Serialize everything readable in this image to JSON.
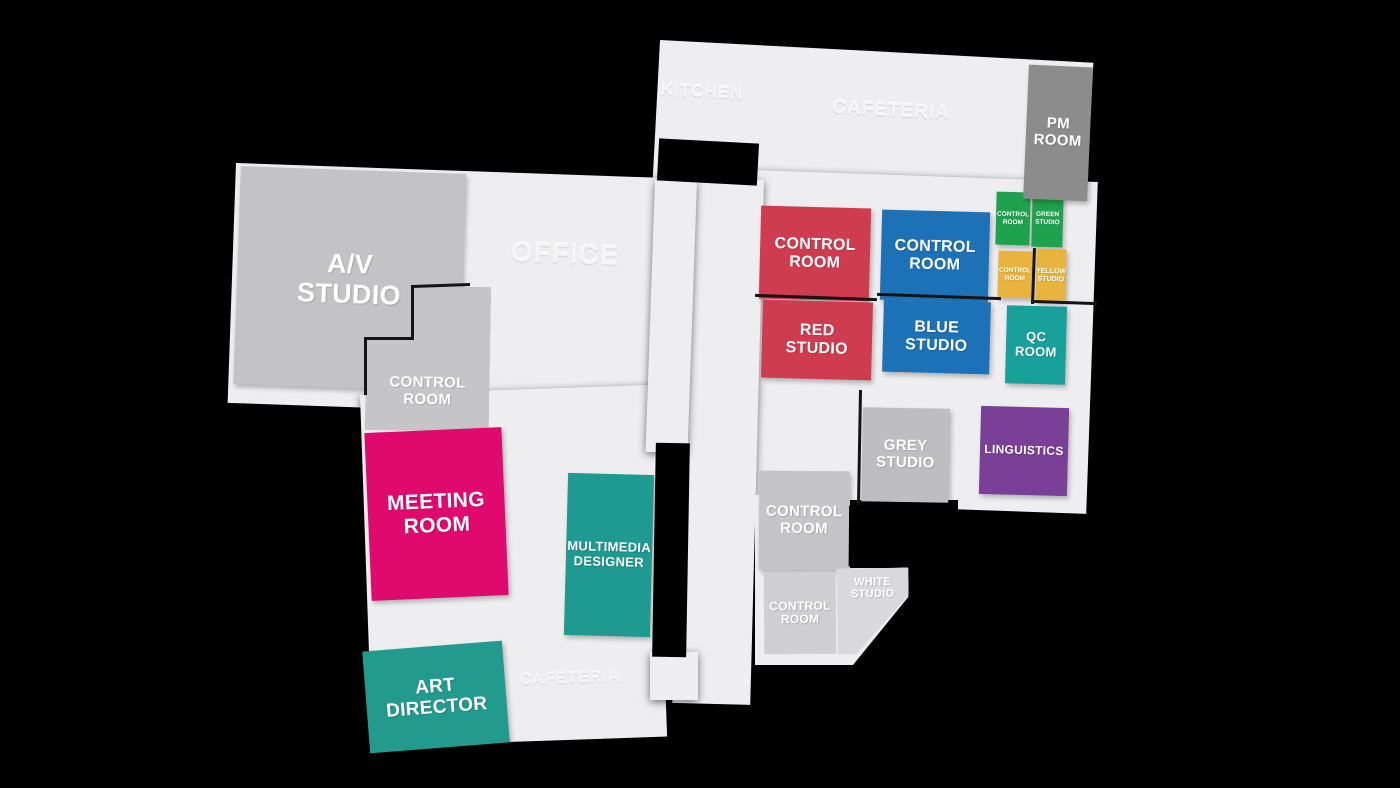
{
  "background": "#000000",
  "floor": {
    "color": "#eeeef0"
  },
  "areas": {
    "kitchen": {
      "label": "KITCHEN"
    },
    "cafeteria": {
      "label": "CAFETERIA"
    },
    "office": {
      "label": "OFFICE"
    },
    "cafeteria_south": {
      "label": "CAFETERIA"
    }
  },
  "rooms": {
    "av_studio": {
      "label": "A/V\nSTUDIO",
      "color": "#c3c3c5"
    },
    "control_room_west": {
      "label": "CONTROL\nROOM",
      "color": "#c5c5c7"
    },
    "meeting_room": {
      "label": "MEETING\nROOM",
      "color": "#e0096e"
    },
    "art_director": {
      "label": "ART\nDIRECTOR",
      "color": "#239a8e"
    },
    "multimedia_designer": {
      "label": "MULTIMEDIA\nDESIGNER",
      "color": "#1f9a90"
    },
    "red_control_room": {
      "label": "CONTROL\nROOM",
      "color": "#d03c4f"
    },
    "red_studio": {
      "label": "RED\nSTUDIO",
      "color": "#d03c4f"
    },
    "blue_control_room": {
      "label": "CONTROL\nROOM",
      "color": "#1d72b7"
    },
    "blue_studio": {
      "label": "BLUE\nSTUDIO",
      "color": "#1d72b7"
    },
    "green_control_room": {
      "label": "CONTROL\nROOM",
      "color": "#1fa24e"
    },
    "green_studio": {
      "label": "GREEN\nSTUDIO",
      "color": "#1fa24e"
    },
    "yellow_control_room": {
      "label": "CONTROL\nROOM",
      "color": "#e9b43d"
    },
    "yellow_studio": {
      "label": "YELLOW\nSTUDIO",
      "color": "#e9b43d"
    },
    "qc_room": {
      "label": "QC\nROOM",
      "color": "#18a09a"
    },
    "pm_room": {
      "label": "PM\nROOM",
      "color": "#8c8c8d"
    },
    "linguistics": {
      "label": "LINGUISTICS",
      "color": "#7a3f97"
    },
    "grey_studio": {
      "label": "GREY\nSTUDIO",
      "color": "#bebec0"
    },
    "control_room_center": {
      "label": "CONTROL\nROOM",
      "color": "#c5c5c7"
    },
    "control_room_south": {
      "label": "CONTROL\nROOM",
      "color": "#cfcfd1"
    },
    "white_studio": {
      "label": "WHITE\nSTUDIO",
      "color": "#d9d9db"
    }
  }
}
